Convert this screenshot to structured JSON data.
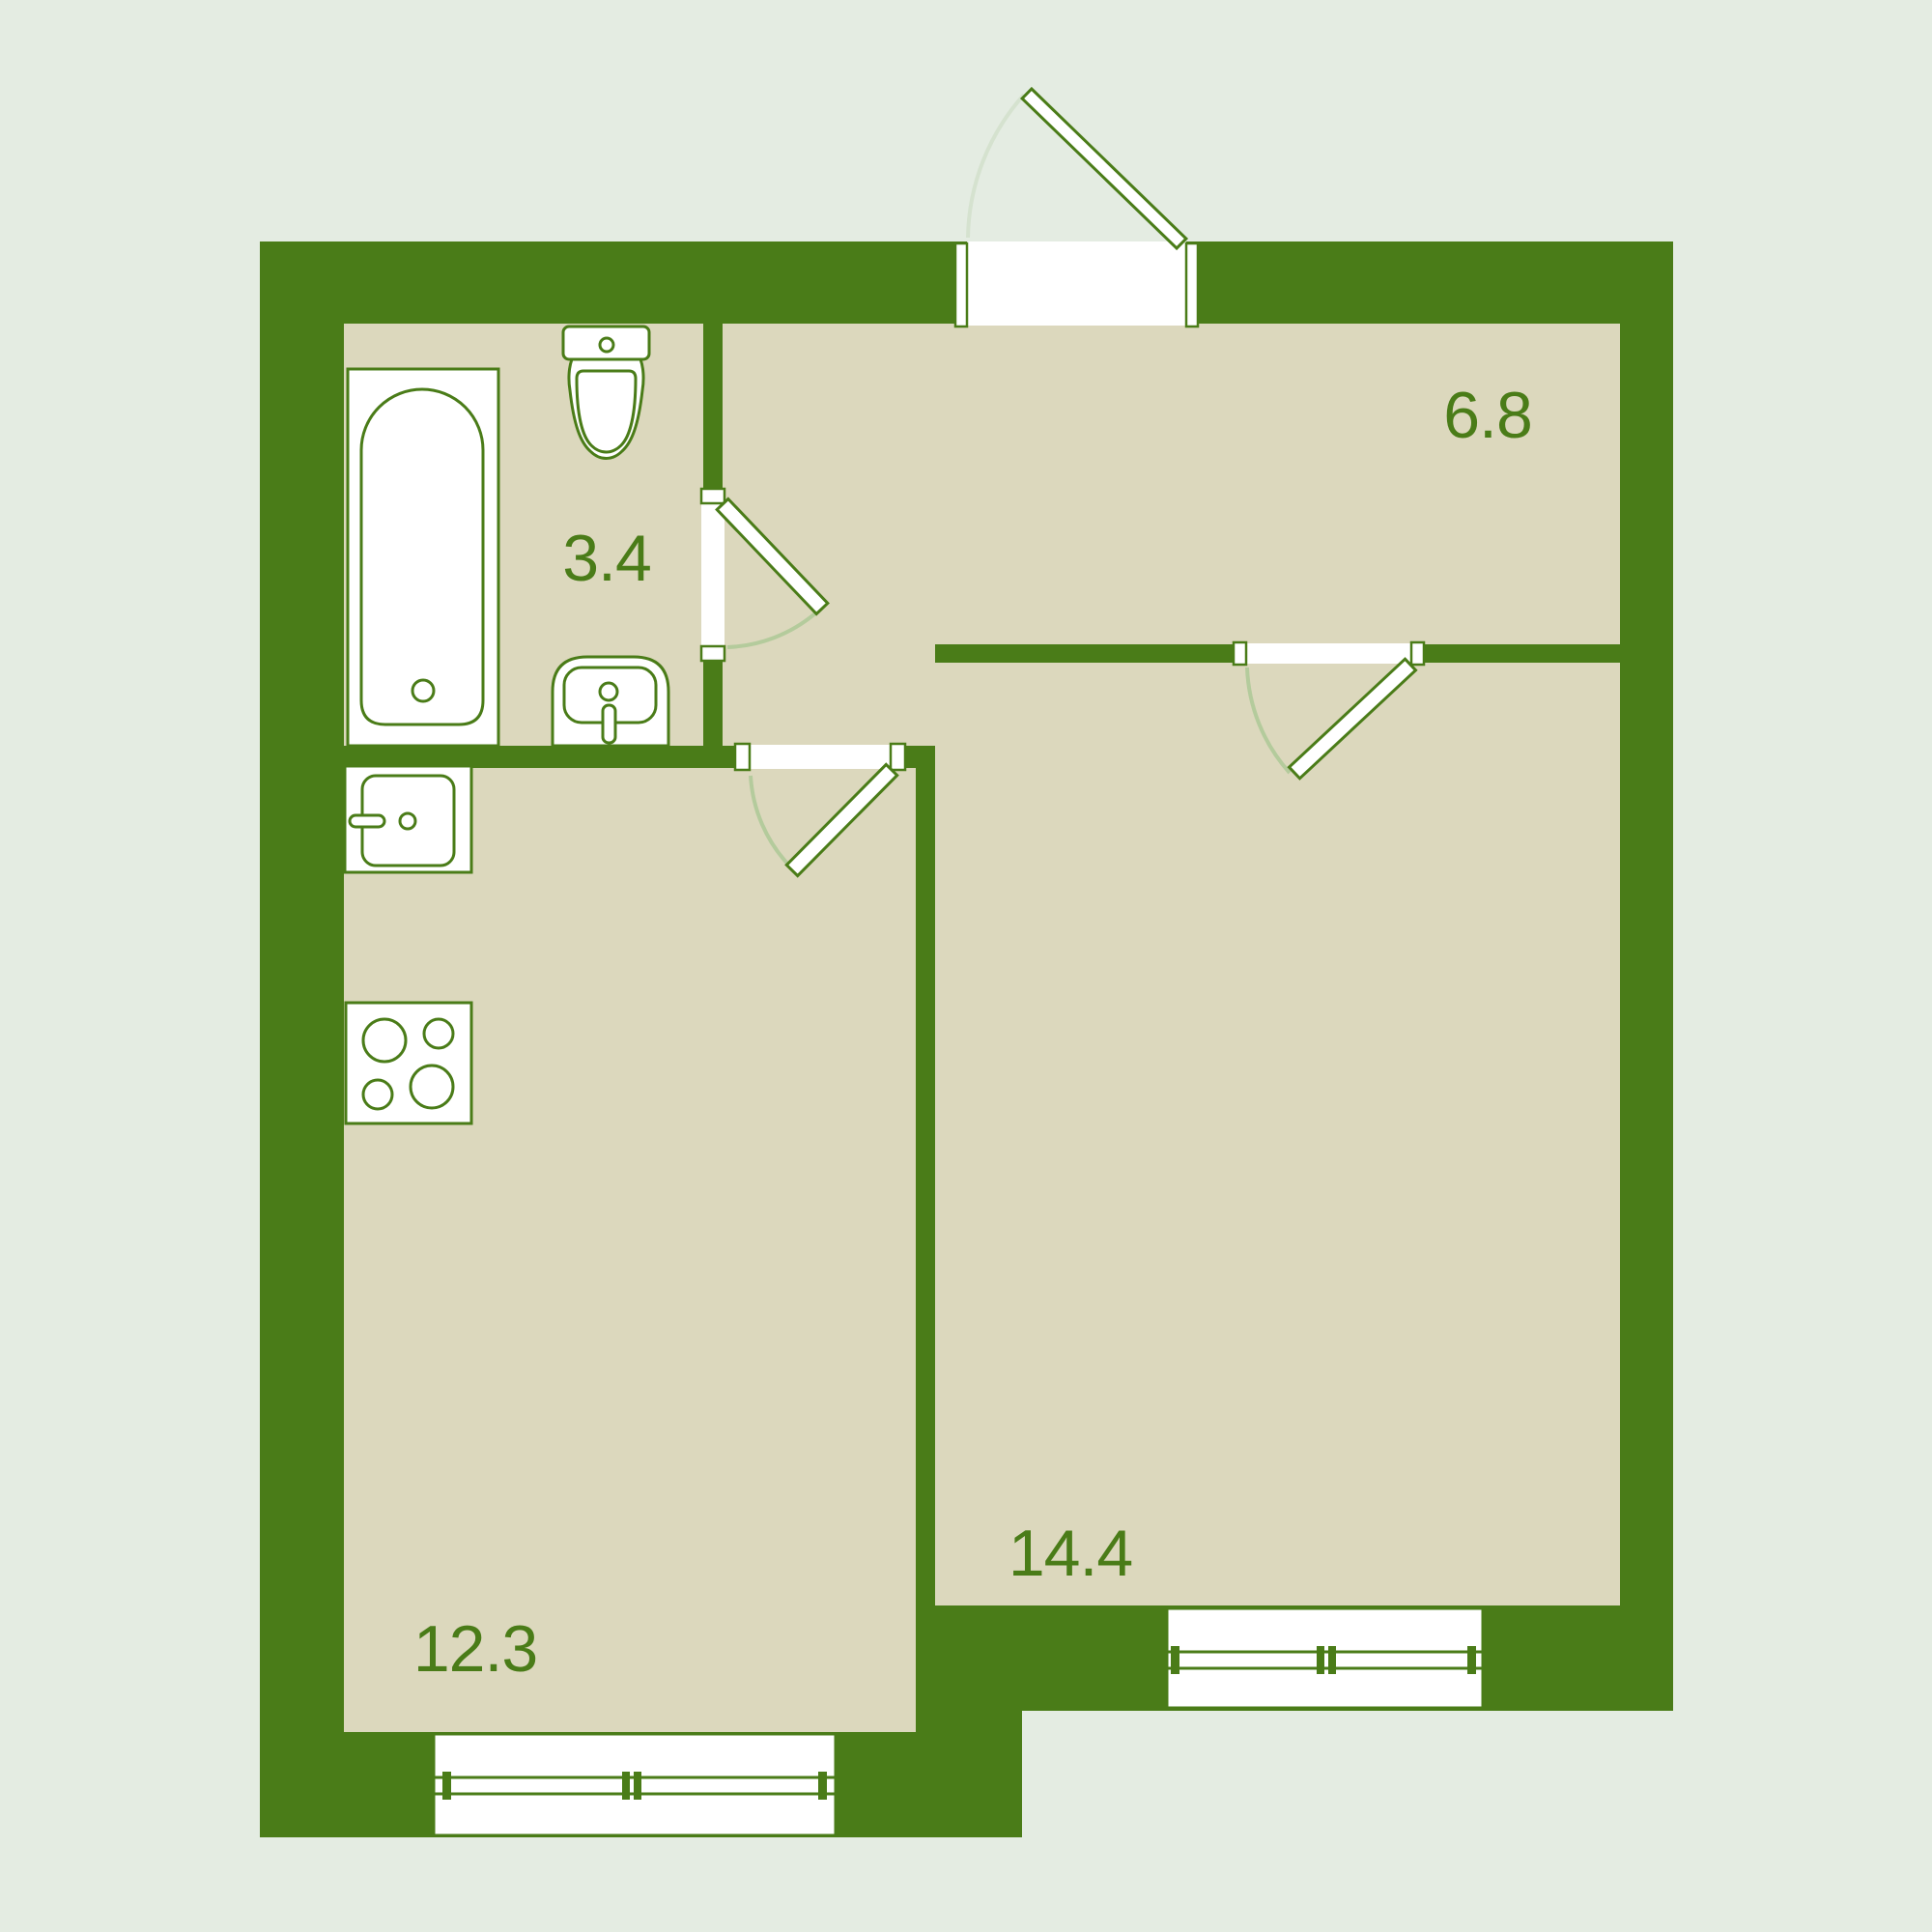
{
  "title": "apartment-floor-plan",
  "rooms": {
    "bathroom": {
      "area_label": "3.4"
    },
    "hallway": {
      "area_label": "6.8"
    },
    "kitchen": {
      "area_label": "12.3"
    },
    "living_room": {
      "area_label": "14.4"
    }
  },
  "icons": {
    "bathtub": "bathtub-icon",
    "toilet": "toilet-icon",
    "bathroom_sink": "bathroom-sink-icon",
    "kitchen_sink": "kitchen-sink-icon",
    "stove": "stove-icon",
    "entrance_door": "entrance-door-leaf",
    "interior_doors": [
      "bathroom-door-leaf",
      "kitchen-door-leaf",
      "living-room-door-leaf"
    ],
    "windows": [
      "kitchen-window",
      "living-room-window"
    ]
  },
  "colors": {
    "wall_green": "#4a7c18",
    "floor_beige": "#dcd8bd",
    "page_background": "#e4ece2",
    "door_arc": "#b4cb9c",
    "entrance_arc": "#d5e2cf",
    "fixture_white": "#ffffff",
    "label_text": "#4a7c18"
  }
}
